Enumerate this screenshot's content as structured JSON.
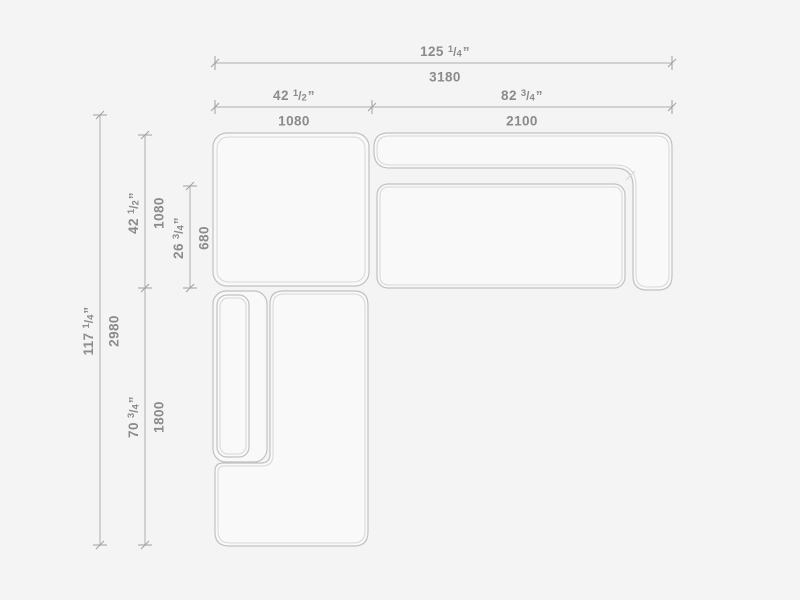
{
  "drawing": {
    "kind": "furniture-dimension-drawing",
    "subject": "sectional-sofa-top-view",
    "colors": {
      "background": "#f4f4f4",
      "outline": "#c1c1c1",
      "inner_line": "#d7d7d7",
      "dimension_line": "#aeaeae",
      "text": "#8b8b8b"
    },
    "dims": {
      "total_width": {
        "in_whole": "125",
        "frac_num": "1",
        "frac_den": "4",
        "unit": "”",
        "mm": "3180"
      },
      "left_width": {
        "in_whole": "42",
        "frac_num": "1",
        "frac_den": "2",
        "unit": "”",
        "mm": "1080"
      },
      "right_width": {
        "in_whole": "82",
        "frac_num": "3",
        "frac_den": "4",
        "unit": "”",
        "mm": "2100"
      },
      "total_depth": {
        "in_whole": "117",
        "frac_num": "1",
        "frac_den": "4",
        "unit": "”",
        "mm": "2980"
      },
      "upper_depth": {
        "in_whole": "42",
        "frac_num": "1",
        "frac_den": "2",
        "unit": "”",
        "mm": "1080"
      },
      "seat_depth": {
        "in_whole": "26",
        "frac_num": "3",
        "frac_den": "4",
        "unit": "”",
        "mm": "680"
      },
      "lower_depth": {
        "in_whole": "70",
        "frac_num": "3",
        "frac_den": "4",
        "unit": "”",
        "mm": "1800"
      }
    }
  }
}
